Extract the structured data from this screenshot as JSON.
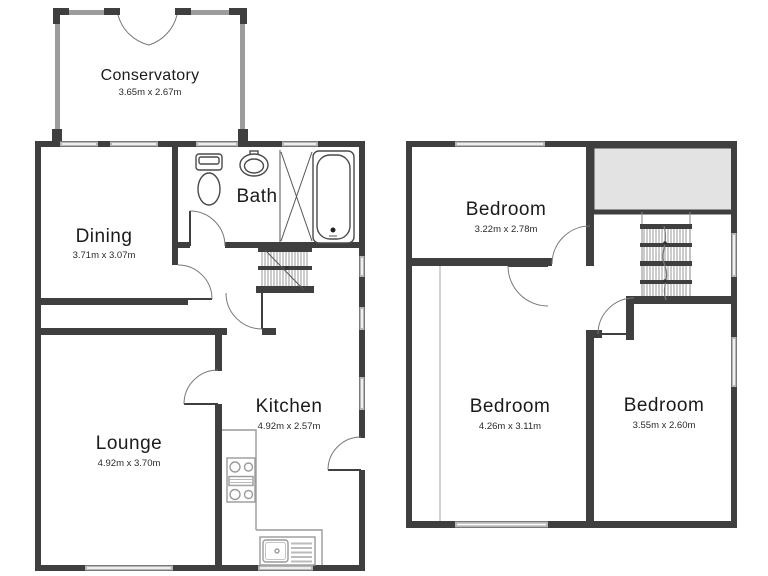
{
  "image": {
    "type": "floor-plan",
    "floors": [
      "ground",
      "first"
    ],
    "background": "#ffffff"
  },
  "colors": {
    "wall": "#3f3f3f",
    "glazed_wall": "#9c9c9c",
    "window": "#b6b6b6",
    "storage_fill": "#e3e3e3",
    "text": "#1b1b1b"
  },
  "ground_floor": {
    "rooms": [
      {
        "id": "conservatory",
        "name": "Conservatory",
        "dimensions": "3.65m x 2.67m"
      },
      {
        "id": "dining",
        "name": "Dining",
        "dimensions": "3.71m x 3.07m"
      },
      {
        "id": "bath",
        "name": "Bath",
        "dimensions": ""
      },
      {
        "id": "lounge",
        "name": "Lounge",
        "dimensions": "4.92m x 3.70m"
      },
      {
        "id": "kitchen",
        "name": "Kitchen",
        "dimensions": "4.92m x 2.57m"
      }
    ],
    "fixtures": [
      "french-doors",
      "toilet",
      "wash-basin",
      "shower",
      "bathtub",
      "staircase",
      "worktop",
      "hob",
      "kitchen-sink"
    ]
  },
  "first_floor": {
    "rooms": [
      {
        "id": "bedroom-1",
        "name": "Bedroom",
        "dimensions": "3.22m x 2.78m"
      },
      {
        "id": "bedroom-2",
        "name": "Bedroom",
        "dimensions": "4.26m x 3.11m"
      },
      {
        "id": "bedroom-3",
        "name": "Bedroom",
        "dimensions": "3.55m x 2.60m"
      }
    ],
    "fixtures": [
      "staircase",
      "storage-void"
    ]
  }
}
